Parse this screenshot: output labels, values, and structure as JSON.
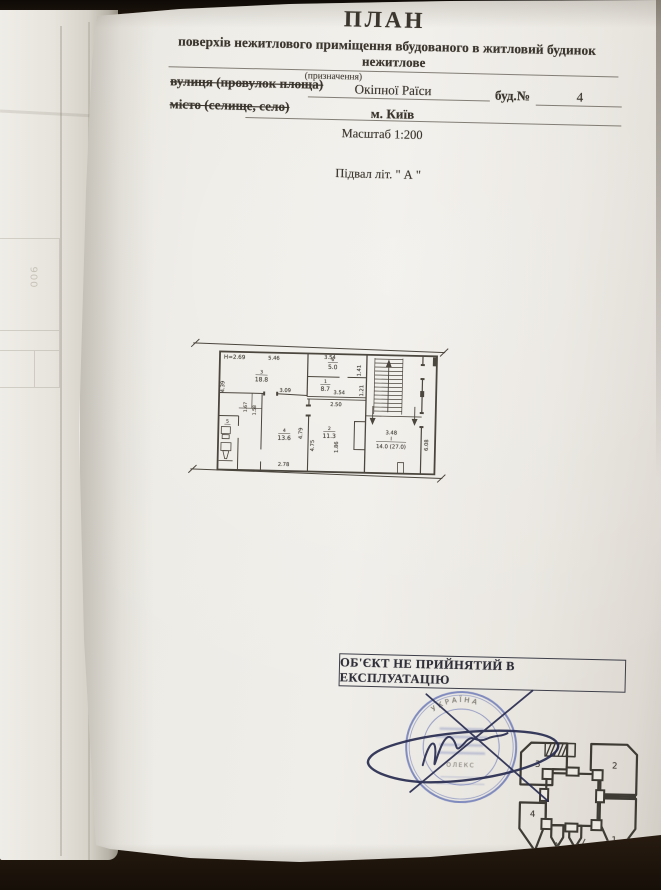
{
  "header": {
    "title": "ПЛАН",
    "subtitle": "поверхів нежитлового приміщення вбудованого в житловий будинок",
    "designation_value": "нежитлове",
    "designation_caption": "(призначення)",
    "street_label": "вулиця (провулок площа)",
    "street_value": "Окіпної Раїси",
    "building_label": "буд.№",
    "building_number": "4",
    "city_label": "місто (селище, село)",
    "city_value": "м. Київ",
    "scale_label": "Масштаб 1:200"
  },
  "plan": {
    "caption": "Підвал літ. \" А \"",
    "height_note": "Н=2.69",
    "rooms": {
      "r18_8": {
        "number": "3",
        "area": "18.8"
      },
      "r5_0": {
        "number": "6",
        "area": "5.0"
      },
      "r8_7": {
        "number": "1",
        "area": "8.7"
      },
      "r13_6": {
        "number": "4",
        "area": "13.6"
      },
      "r11_3": {
        "number": "2",
        "area": "11.3"
      },
      "wc": {
        "number": "5"
      },
      "stair": {
        "number": "I",
        "area": "14.0 (27.0)"
      }
    },
    "dims": {
      "d546": "5.46",
      "d354a": "3.54",
      "d141": "1.41",
      "d439": "4.39",
      "d309": "3.09",
      "d354b": "3.54",
      "d250": "2.50",
      "d121": "1.21",
      "d167": "1.67",
      "d158": "1.58",
      "d479": "4.79",
      "d475": "4.75",
      "d186": "1.86",
      "d278": "2.78",
      "d348": "3.48",
      "d608": "6.08"
    }
  },
  "approval": {
    "box_text": "ОБ'ЄКТ НЕ ПРИЙНЯТИЙ В ЕКСПЛУАТАЦІЮ"
  },
  "stamp": {
    "ring_text": "УКРАЇНА",
    "center_fragment": "ОЛЕКС",
    "ink": "#4254a8"
  },
  "site_plan": {
    "sections": [
      "1",
      "2",
      "3",
      "4"
    ]
  },
  "underlying_page": {
    "fragment_text": "900"
  }
}
